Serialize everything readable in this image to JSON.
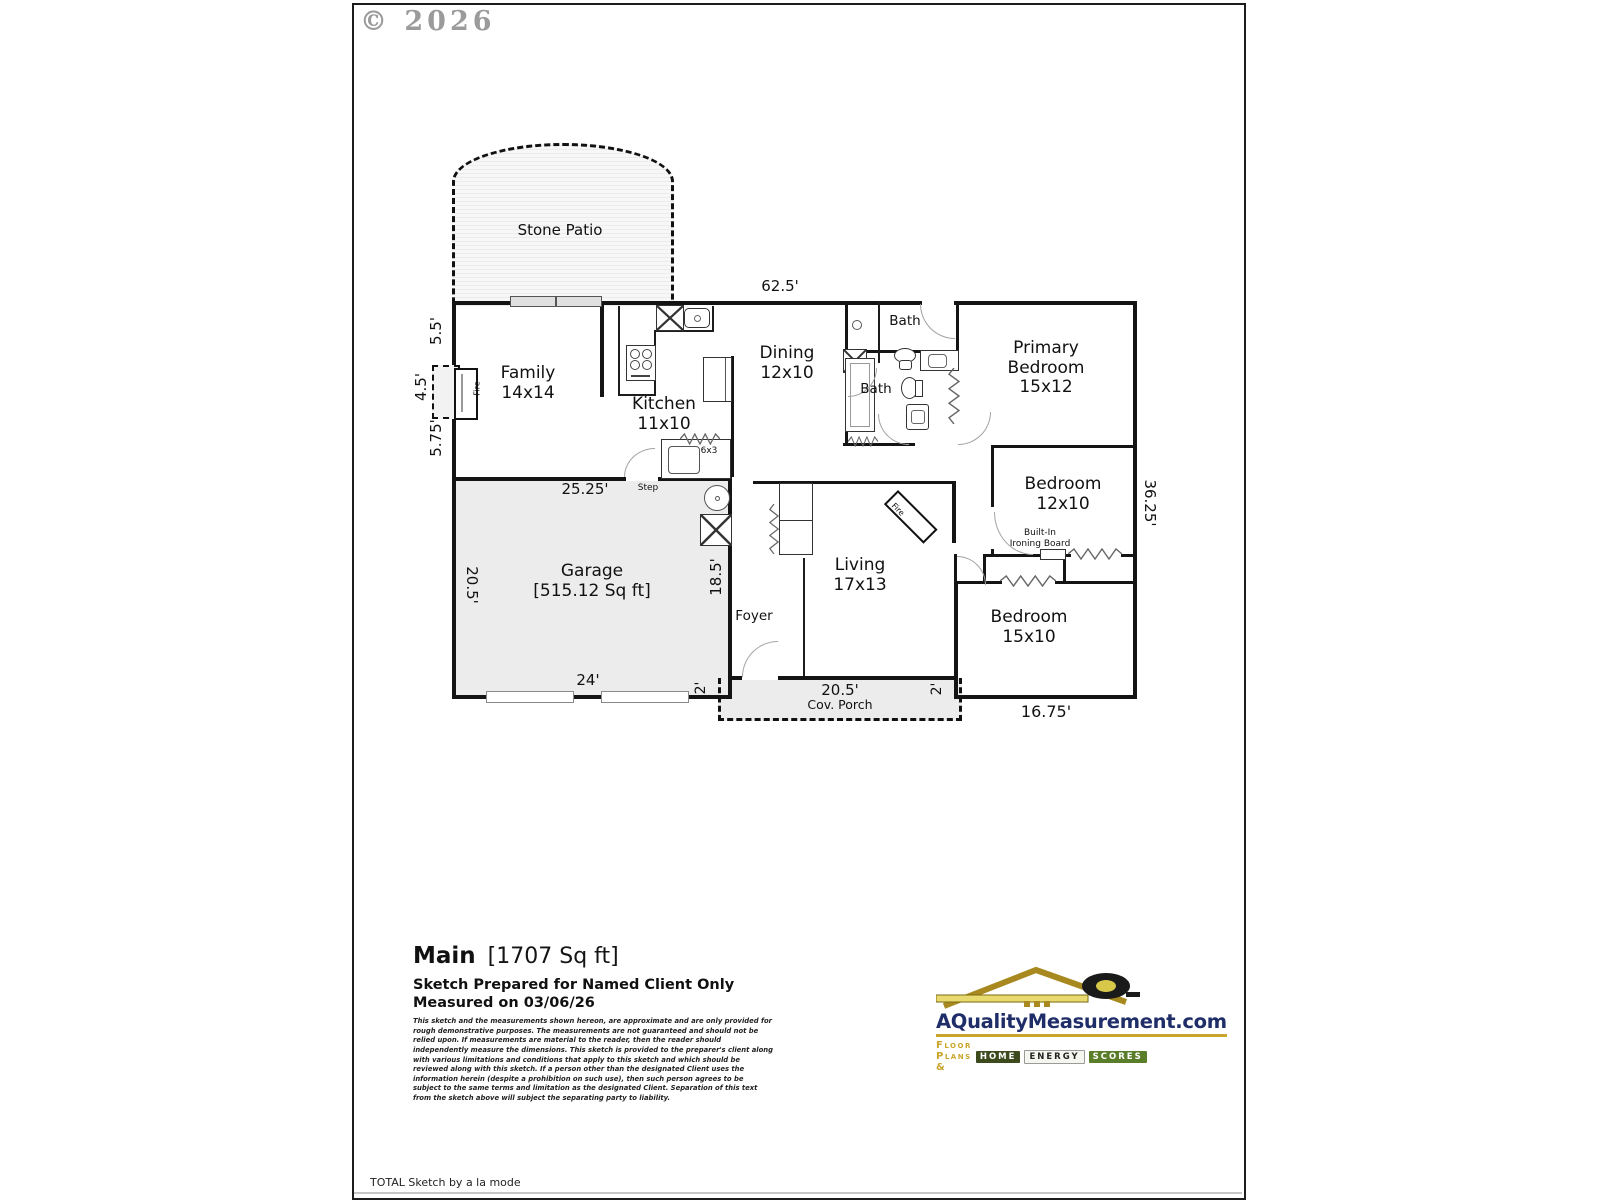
{
  "page": {
    "copyright": "© 2026",
    "footer_note": "TOTAL Sketch by a la mode"
  },
  "floorplan": {
    "outdoor": {
      "stone_patio": "Stone Patio",
      "cov_porch": "Cov. Porch",
      "porch_width": "20.5'"
    },
    "rooms": {
      "family": {
        "name": "Family",
        "size": "14x14"
      },
      "kitchen": {
        "name": "Kitchen",
        "size": "11x10"
      },
      "dining": {
        "name": "Dining",
        "size": "12x10"
      },
      "bath_hall": {
        "name": "Bath"
      },
      "bath_primary": {
        "name": "Bath"
      },
      "primary_bedroom": {
        "line1": "Primary",
        "line2": "Bedroom",
        "size": "15x12"
      },
      "bedroom_mid": {
        "name": "Bedroom",
        "size": "12x10"
      },
      "bedroom_front": {
        "name": "Bedroom",
        "size": "15x10"
      },
      "living": {
        "name": "Living",
        "size": "17x13"
      },
      "foyer": {
        "name": "Foyer"
      },
      "garage": {
        "name": "Garage",
        "size": "[515.12 Sq ft]"
      }
    },
    "dimensions": {
      "top": "62.5'",
      "left_upper": "5.5'",
      "left_fireplace": "4.5'",
      "left_lower": "5.75'",
      "garage_top": "25.25'",
      "garage_left": "20.5'",
      "garage_right": "18.5'",
      "garage_bottom": "24'",
      "porch_side_left": "2'",
      "porch_side_right": "2'",
      "bottom_right": "16.75'",
      "right": "36.25'"
    },
    "annotations": {
      "step": "Step",
      "fire_family": "Fire",
      "fire_living": "Fire",
      "pantry": "6x3",
      "ironing_line1": "Built-In",
      "ironing_line2": "Ironing Board"
    }
  },
  "summary": {
    "level": "Main",
    "area": "[1707 Sq ft]",
    "prepared_for": "Sketch Prepared for Named Client Only",
    "measured_on": "Measured on 03/06/26",
    "disclaimer": "This sketch and the measurements shown hereon, are approximate and are only provided for rough demonstrative purposes.  The measurements are not guaranteed and should not be relied upon.  If measurements are material to the reader, then the reader should independently measure the dimensions.  This sketch is provided to the preparer's client along with various limitations and conditions that apply to this sketch and which should be reviewed along with this sketch.  If a person other than the designated Client uses the information herein (despite a prohibition on such use), then such person agrees to be subject to the same terms and limitation as the designated Client.  Separation of this text from the sketch above will subject the separating party to liability."
  },
  "branding": {
    "site": "AQualityMeasurement.com",
    "tagline_prefix": "Floor Plans &",
    "tiles": [
      "Home",
      "Energy",
      "Scores"
    ]
  }
}
